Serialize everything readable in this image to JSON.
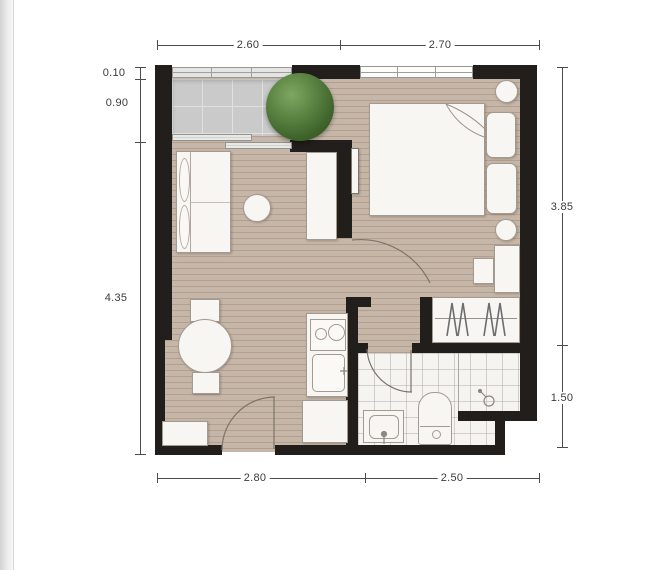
{
  "plan": {
    "dims": {
      "top": [
        {
          "label": "2.60"
        },
        {
          "label": "2.70"
        }
      ],
      "bottom": [
        {
          "label": "2.80"
        },
        {
          "label": "2.50"
        }
      ],
      "left": [
        {
          "label": "0.10"
        },
        {
          "label": "0.90"
        },
        {
          "label": "4.35"
        }
      ],
      "right": [
        {
          "label": "3.85"
        },
        {
          "label": "1.50"
        }
      ]
    },
    "colors": {
      "wall": "#221e1b",
      "wood_floor": "#c6b6a8",
      "balcony_floor": "#cacaca",
      "bathroom_floor": "#f5f4f1",
      "plant_green": "#55803f",
      "furniture": "#f8f6f3",
      "dimension_text": "#3b3b3b"
    }
  }
}
